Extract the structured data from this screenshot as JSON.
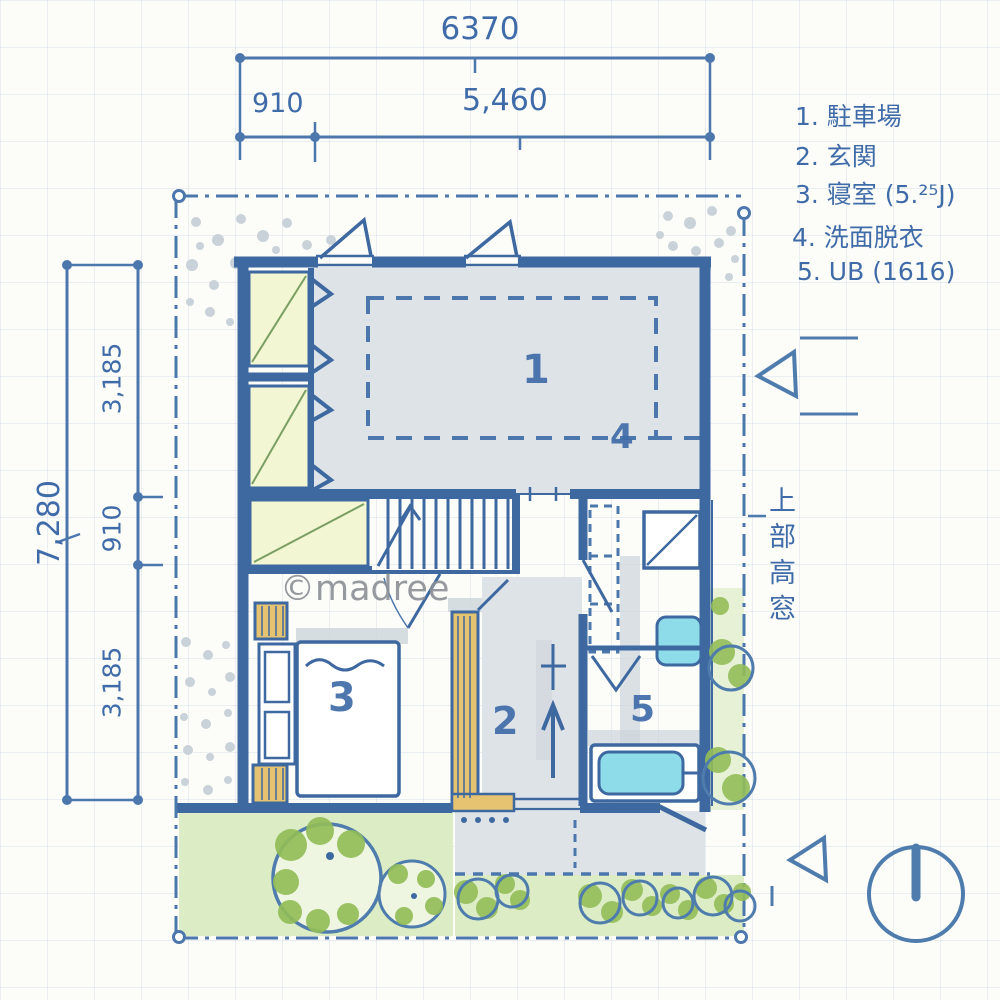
{
  "legend": {
    "items": [
      {
        "text": "1. 駐車場"
      },
      {
        "text": "2. 玄関"
      },
      {
        "text": "3. 寝室 (5.²⁵J)"
      },
      {
        "text": "4. 洗面脱衣"
      },
      {
        "text": "5. UB (1616)"
      }
    ]
  },
  "dimensions": {
    "top_total": "6370",
    "top_left": "910",
    "top_right": "5,460",
    "left_total": "7,280",
    "left_upper": "3,185",
    "left_middle": "910",
    "left_lower": "3,185"
  },
  "room_labels": {
    "parking": "1",
    "entrance": "2",
    "bedroom": "3",
    "washroom": "4",
    "bathroom": "5"
  },
  "annotations": {
    "high_window_note": "上部高窓",
    "watermark": "©madree"
  },
  "colors": {
    "ink_blue": "#3f6ca8",
    "wall_blue": "#3e68a0",
    "floor_gray": "#dee3e7",
    "closet_yellow": "#f3f6d2",
    "wood_tan": "#e6c370",
    "water_cyan": "#8edbea",
    "foliage_green": "#93bd58",
    "lawn_green": "#dcecc5",
    "gravel_gray": "#c9d2d8",
    "watermark_gray": "#8b9095"
  }
}
